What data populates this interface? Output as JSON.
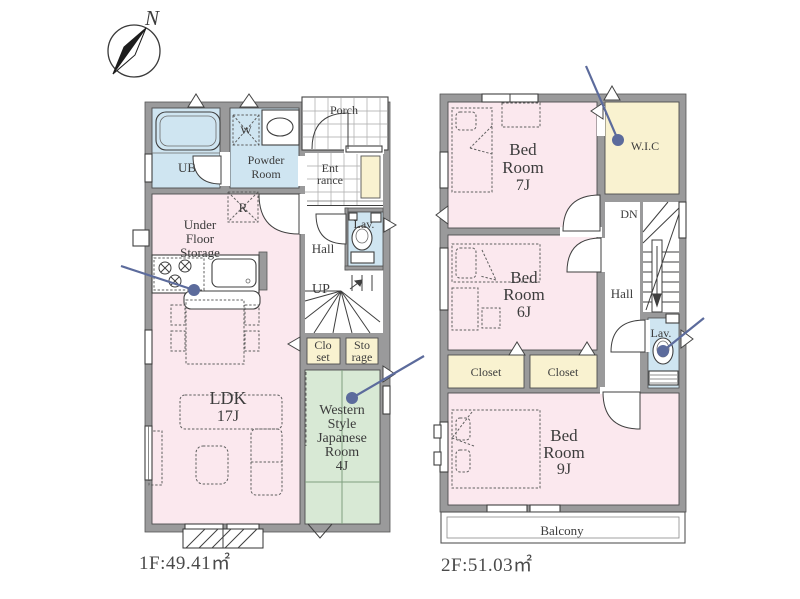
{
  "document": {
    "type": "real-estate-floor-plan",
    "background": "#ffffff"
  },
  "colors": {
    "room_pink": "#fbe8ee",
    "room_blue": "#cfe5f1",
    "room_cream": "#f9f2d0",
    "room_green": "#d8e9d5",
    "wall_gray": "#9a9a9b",
    "text_dark": "#3c3c3c",
    "camera_marker_blue": "#5c6b9c"
  },
  "compass": {
    "north_label": "N"
  },
  "floor1": {
    "area_label": "1F:49.41㎡",
    "labels": {
      "ub": "UB",
      "powder_1": "Powder",
      "powder_2": "Room",
      "washer": "W",
      "porch": "Porch",
      "entrance_1": "Ent",
      "entrance_2": "rance",
      "lav": "Lav.",
      "hall": "Hall",
      "up": "UP",
      "fridge": "R",
      "under_floor_1": "Under",
      "under_floor_2": "Floor",
      "under_floor_3": "Storage",
      "ldk_1": "LDK",
      "ldk_2": "17J",
      "closet_1": "Clo",
      "closet_2": "set",
      "storage_1": "Sto",
      "storage_2": "rage",
      "japanese_1": "Western",
      "japanese_2": "Style",
      "japanese_3": "Japanese",
      "japanese_4": "Room",
      "japanese_5": "4J"
    }
  },
  "floor2": {
    "area_label": "2F:51.03㎡",
    "labels": {
      "bed7_1": "Bed",
      "bed7_2": "Room",
      "bed7_3": "7J",
      "wic": "W.I.C",
      "dn": "DN",
      "bed6_1": "Bed",
      "bed6_2": "Room",
      "bed6_3": "6J",
      "hall": "Hall",
      "lav": "Lav.",
      "closet_a": "Closet",
      "closet_b": "Closet",
      "bed9_1": "Bed",
      "bed9_2": "Room",
      "bed9_3": "9J",
      "balcony": "Balcony"
    }
  }
}
